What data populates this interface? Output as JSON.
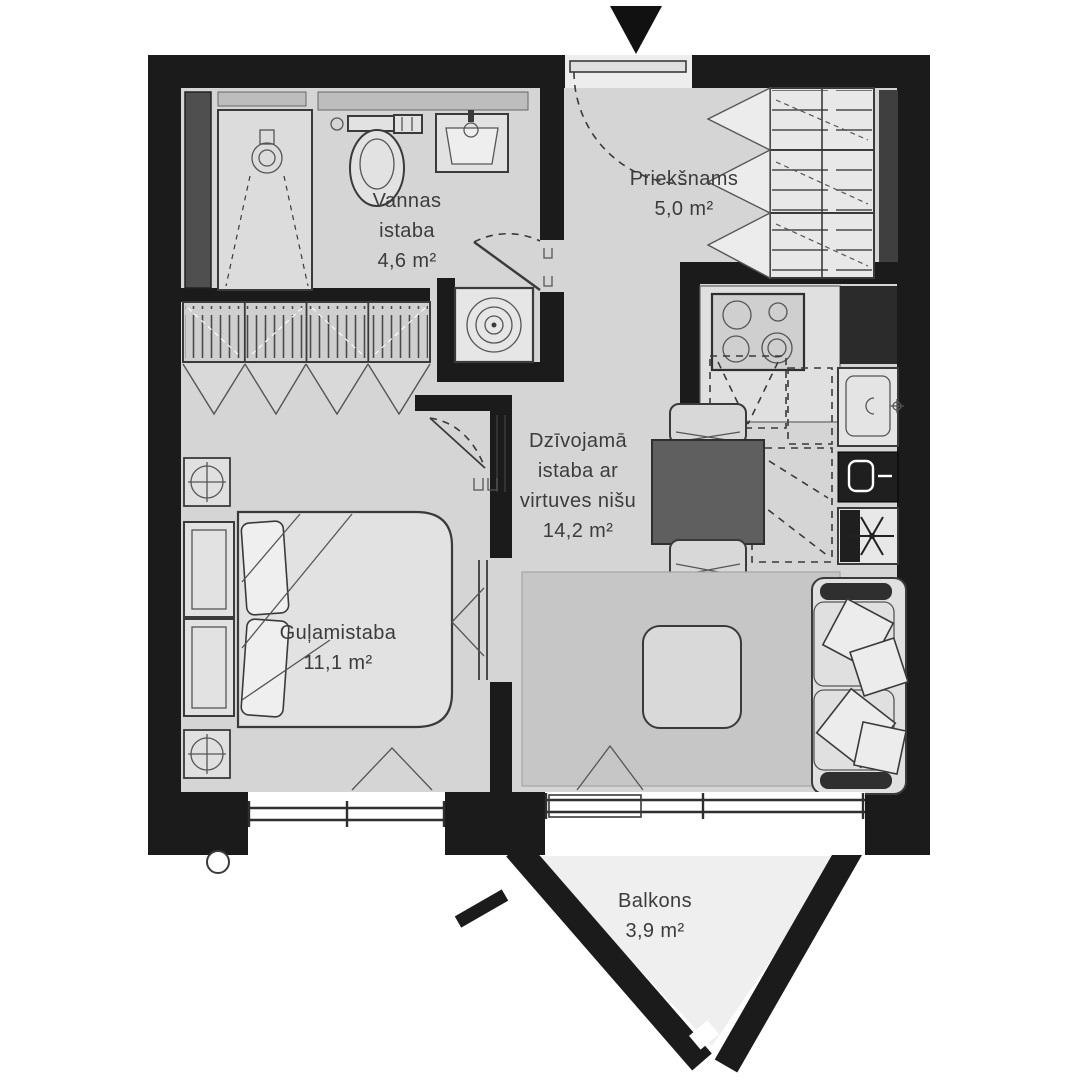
{
  "plan": {
    "title": "Apartment floor plan",
    "rooms": [
      {
        "id": "vannas-istaba",
        "name": "Vannas istaba",
        "area": "4,6 m²"
      },
      {
        "id": "prieksnams",
        "name": "Priekšnams",
        "area": "5,0 m²"
      },
      {
        "id": "dzivojama-istaba",
        "name": "Dzīvojamā istaba ar virtuves nišu",
        "area": "14,2 m²"
      },
      {
        "id": "gulamistaba",
        "name": "Guļamistaba",
        "area": "11,1 m²"
      },
      {
        "id": "balkons",
        "name": "Balkons",
        "area": "3,9 m²"
      }
    ],
    "icons": {
      "entrance-arrow-icon": "black triangle pointing down at entrance door",
      "shower-icon": "shower head circle with dashed spray cone",
      "toilet-icon": "toilet bowl with cistern",
      "bathroom-sink-icon": "wash basin with tap",
      "towel-radiator-icon": "small wall radiator",
      "washing-machine-icon": "square with spiral drum",
      "wardrobe-shelves-icon": "shelving with folding doors",
      "closet-rail-icon": "hanging rail with folding doors",
      "stove-icon": "4-burner hob",
      "kitchen-sink-icon": "sink with drain and tap",
      "oven-icon": "dark appliance front",
      "fridge-snowflake-icon": "asterisk snowflake",
      "dining-table-icon": "square table with two chairs",
      "coffee-table-icon": "rounded square table",
      "sofa-icon": "two-seat sofa with cushions",
      "bed-icon": "double bed with pillows",
      "ceiling-fixture-icon": "circle with crosshair in square",
      "window-icon": "double glazing line with mullion ticks",
      "door-swing-icon": "door leaf with dashed swing arc"
    },
    "colors": {
      "wall": "#1b1b1b",
      "floor": "#d5d5d5",
      "rug": "#c6c6c6",
      "furniture_fill": "#e2e2e2",
      "appliance_dark": "#262626",
      "label_text": "#3c3c3c"
    }
  }
}
